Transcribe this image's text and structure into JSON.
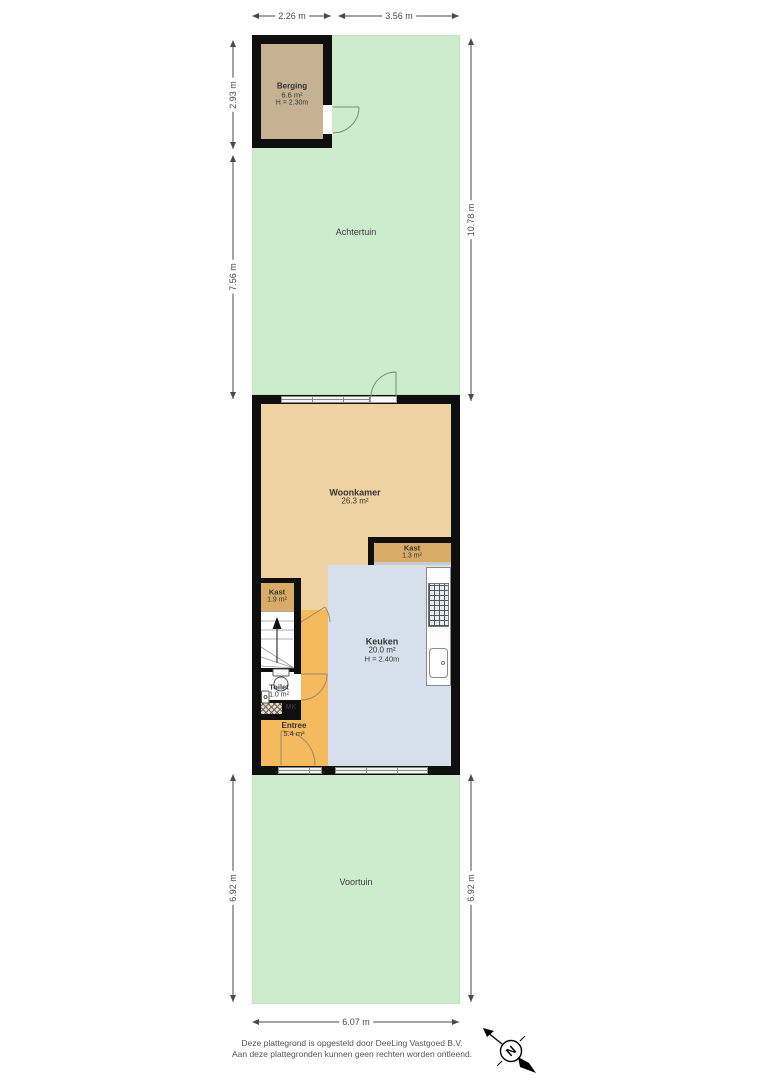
{
  "colors": {
    "garden": "#cdeccd",
    "wall": "#0f0f0f",
    "berging_int": "#c6b293",
    "woonkamer": "#efd2a2",
    "kast": "#d8ab66",
    "entree": "#f5b95e",
    "keuken": "#d6e0ec",
    "dim": "#4a4a4a",
    "label": "#333333"
  },
  "gardens": {
    "achtertuin": "Achtertuin",
    "voortuin": "Voortuin"
  },
  "rooms": {
    "berging": {
      "name": "Berging",
      "area": "6.6 m²",
      "height": "H = 2.30m"
    },
    "woonkamer": {
      "name": "Woonkamer",
      "area": "26.3 m²"
    },
    "kast_woonkamer": {
      "name": "Kast",
      "area": "1.3 m²"
    },
    "kast_hal": {
      "name": "Kast",
      "area": "1.9 m²"
    },
    "keuken": {
      "name": "Keuken",
      "area": "20.0 m²",
      "height": "H = 2.40m"
    },
    "toilet": {
      "name": "Toilet",
      "area": "1.0 m²"
    },
    "meterkast": {
      "name": "MK"
    },
    "entree": {
      "name": "Entree",
      "area": "5.4 m²"
    }
  },
  "dimensions": {
    "berging_breedte": "2.26 m",
    "achtertuin_breedte": "3.56 m",
    "berging_diepte": "2.93 m",
    "achtertuin_links": "7.56 m",
    "achtertuin_rechts": "10.78 m",
    "voortuin_links": "6.92 m",
    "voortuin_rechts": "6.92 m",
    "voortuin_breedte": "6.07 m"
  },
  "compass": {
    "north": "N"
  },
  "footer": {
    "line1": "Deze plattegrond is opgesteld door DeeLing Vastgoed B.V.",
    "line2": "Aan deze plattegronden kunnen geen rechten worden ontleend."
  }
}
